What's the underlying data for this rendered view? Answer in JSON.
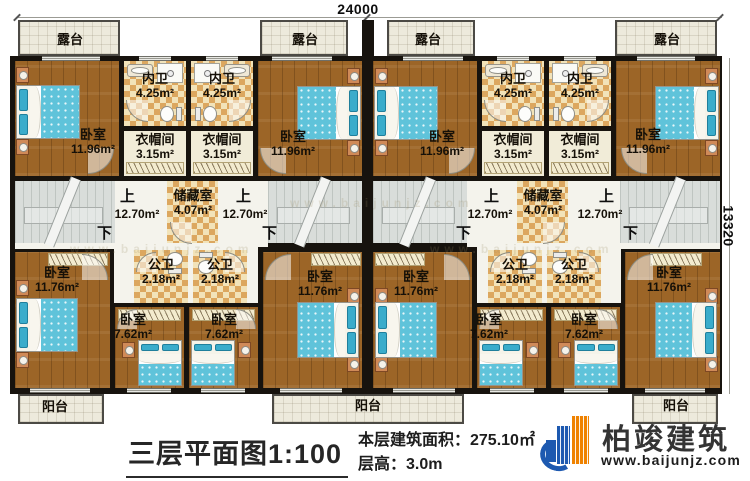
{
  "page": {
    "dim_top": "24000",
    "dim_right": "13320",
    "title": "三层平面图1:100",
    "area_line": "本层建筑面积：275.10㎡",
    "height_line": "层高：3.0m",
    "brand": "柏竣建筑",
    "site": "www.baijunjz.com",
    "watermark": "www.baijunjz.com",
    "up": "上",
    "down": "下"
  },
  "rooms": {
    "terrace1": {
      "label": "露台"
    },
    "terrace2": {
      "label": "露台"
    },
    "terrace3": {
      "label": "露台"
    },
    "terrace4": {
      "label": "露台"
    },
    "balcony1": {
      "label": "阳台"
    },
    "balcony2": {
      "label": "阳台"
    },
    "balcony3": {
      "label": "阳台"
    },
    "bed1": {
      "label": "卧室",
      "area": "11.96m²"
    },
    "bed2": {
      "label": "卧室",
      "area": "11.96m²"
    },
    "bed3": {
      "label": "卧室",
      "area": "11.96m²"
    },
    "bed4": {
      "label": "卧室",
      "area": "11.96m²"
    },
    "nei1": {
      "label": "内卫",
      "area": "4.25m²"
    },
    "nei2": {
      "label": "内卫",
      "area": "4.25m²"
    },
    "nei3": {
      "label": "内卫",
      "area": "4.25m²"
    },
    "nei4": {
      "label": "内卫",
      "area": "4.25m²"
    },
    "yi1": {
      "label": "衣帽间",
      "area": "3.15m²"
    },
    "yi2": {
      "label": "衣帽间",
      "area": "3.15m²"
    },
    "yi3": {
      "label": "衣帽间",
      "area": "3.15m²"
    },
    "yi4": {
      "label": "衣帽间",
      "area": "3.15m²"
    },
    "hall1": {
      "area": "12.70m²"
    },
    "hall2": {
      "area": "12.70m²"
    },
    "hall3": {
      "area": "12.70m²"
    },
    "hall4": {
      "area": "12.70m²"
    },
    "store1": {
      "label": "储藏室",
      "area": "4.07m²"
    },
    "store2": {
      "label": "储藏室",
      "area": "4.07m²"
    },
    "gw1": {
      "label": "公卫",
      "area": "2.18m²"
    },
    "gw2": {
      "label": "公卫",
      "area": "2.18m²"
    },
    "gw3": {
      "label": "公卫",
      "area": "2.18m²"
    },
    "gw4": {
      "label": "公卫",
      "area": "2.18m²"
    },
    "bed5": {
      "label": "卧室",
      "area": "11.76m²"
    },
    "bed8": {
      "label": "卧室",
      "area": "11.76m²"
    },
    "bed9": {
      "label": "卧室",
      "area": "11.76m²"
    },
    "bed12": {
      "label": "卧室",
      "area": "11.76m²"
    },
    "bed6": {
      "label": "卧室",
      "area": "7.62m²"
    },
    "bed7": {
      "label": "卧室",
      "area": "7.62m²"
    },
    "bed10": {
      "label": "卧室",
      "area": "7.62m²"
    },
    "bed11": {
      "label": "卧室",
      "area": "7.62m²"
    }
  }
}
